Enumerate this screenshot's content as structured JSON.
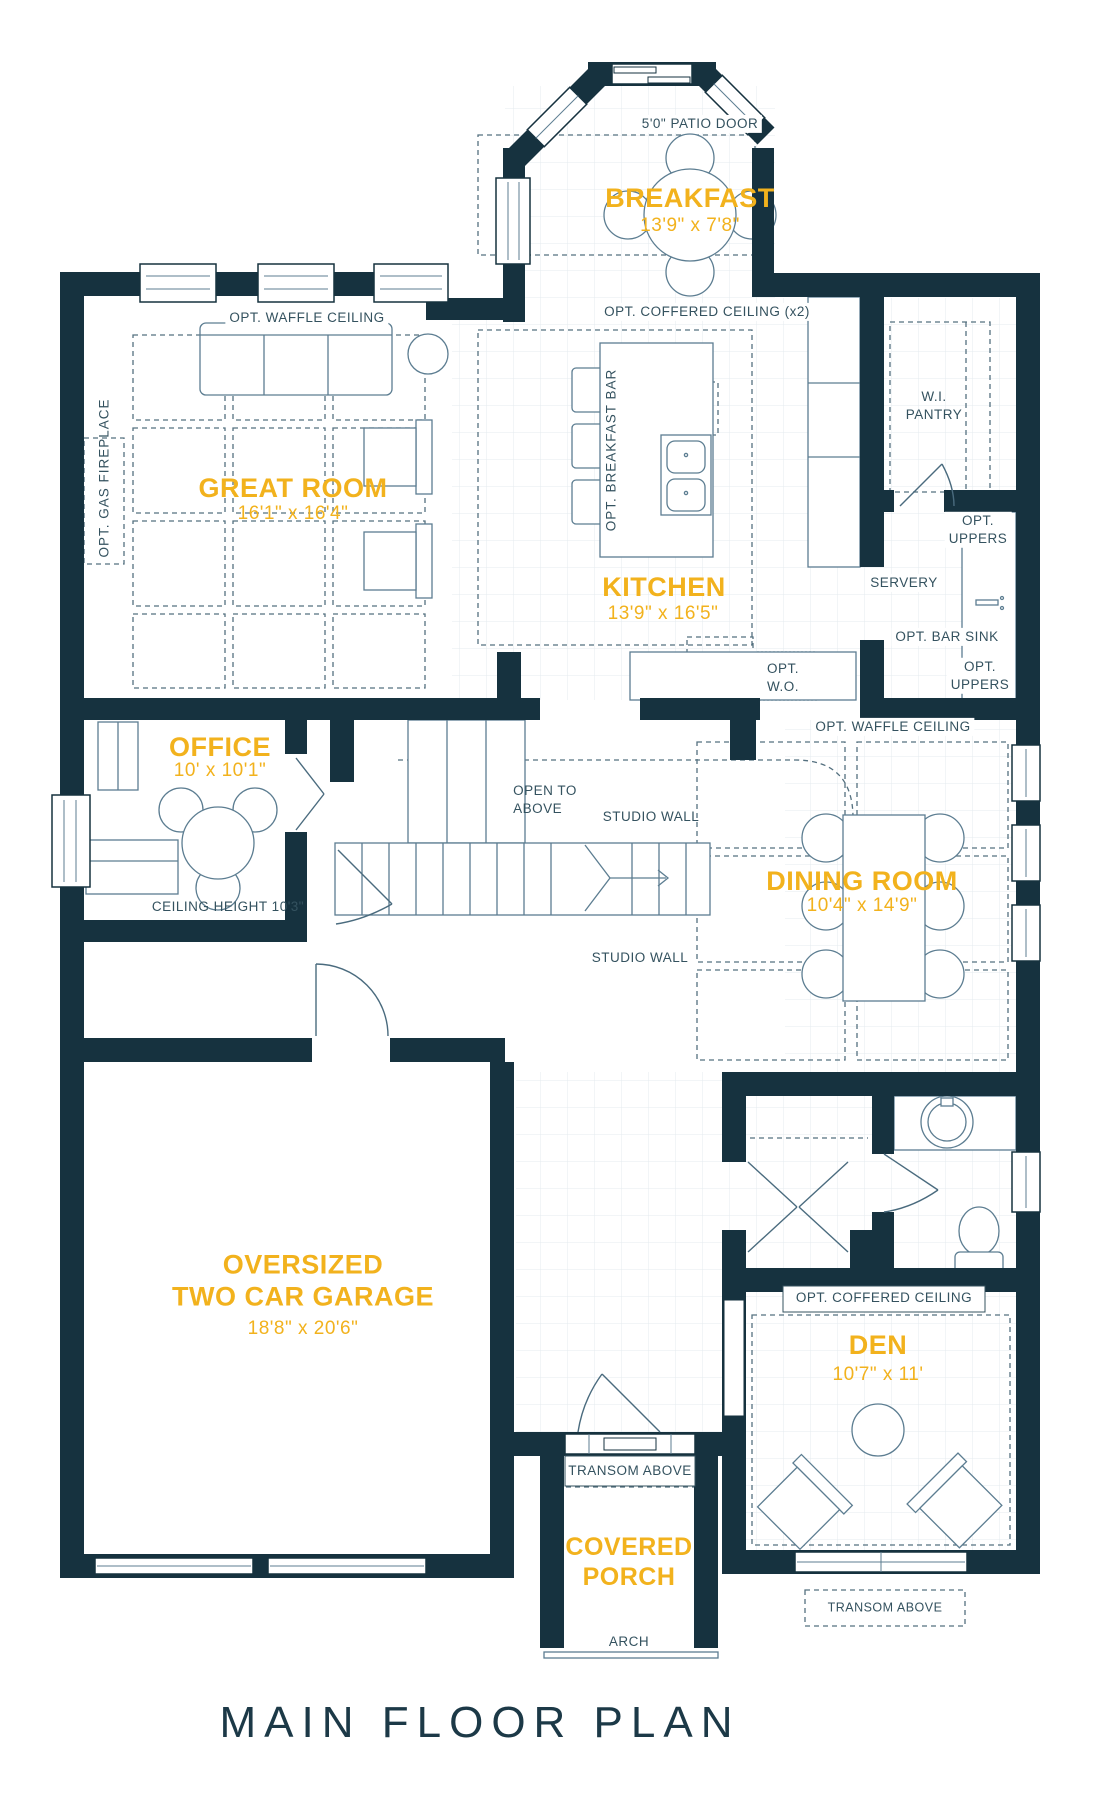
{
  "title": "MAIN FLOOR PLAN",
  "colors": {
    "wall": "#16323F",
    "accent": "#F2B21D",
    "line": "#5C7D91",
    "label": "#34525F"
  },
  "rooms": {
    "breakfast": {
      "name": "BREAKFAST",
      "dims": "13'9\" x 7'8\""
    },
    "great_room": {
      "name": "GREAT ROOM",
      "dims": "16'1\" x 16'4\""
    },
    "kitchen": {
      "name": "KITCHEN",
      "dims": "13'9\" x 16'5\""
    },
    "office": {
      "name": "OFFICE",
      "dims": "10' x 10'1\""
    },
    "dining_room": {
      "name": "DINING ROOM",
      "dims": "10'4\" x 14'9\""
    },
    "garage": {
      "name": "OVERSIZED\nTWO CAR GARAGE",
      "dims": "18'8\" x 20'6\""
    },
    "den": {
      "name": "DEN",
      "dims": "10'7\" x 11'"
    },
    "covered_porch": {
      "name": "COVERED\nPORCH"
    }
  },
  "labels": {
    "patio_door": "5'0\" PATIO DOOR",
    "waffle_ceiling_great": "OPT. WAFFLE CEILING",
    "coffered_ceiling_x2": "OPT. COFFERED CEILING (x2)",
    "gas_fireplace": "OPT. GAS FIREPLACE",
    "breakfast_bar": "OPT. BREAKFAST BAR",
    "wi_pantry": "W.I.\nPANTRY",
    "opt_uppers": "OPT.\nUPPERS",
    "servery": "SERVERY",
    "opt_bar_sink": "OPT.  BAR SINK",
    "opt_wo": "OPT.\nW.O.",
    "waffle_ceiling_dining": "OPT. WAFFLE CEILING",
    "open_to_above": "OPEN TO\nABOVE",
    "studio_wall": "STUDIO WALL",
    "ceiling_height": "CEILING HEIGHT 10'3\"",
    "coffered_ceiling_den": "OPT. COFFERED CEILING",
    "transom_above": "TRANSOM ABOVE",
    "arch": "ARCH"
  }
}
